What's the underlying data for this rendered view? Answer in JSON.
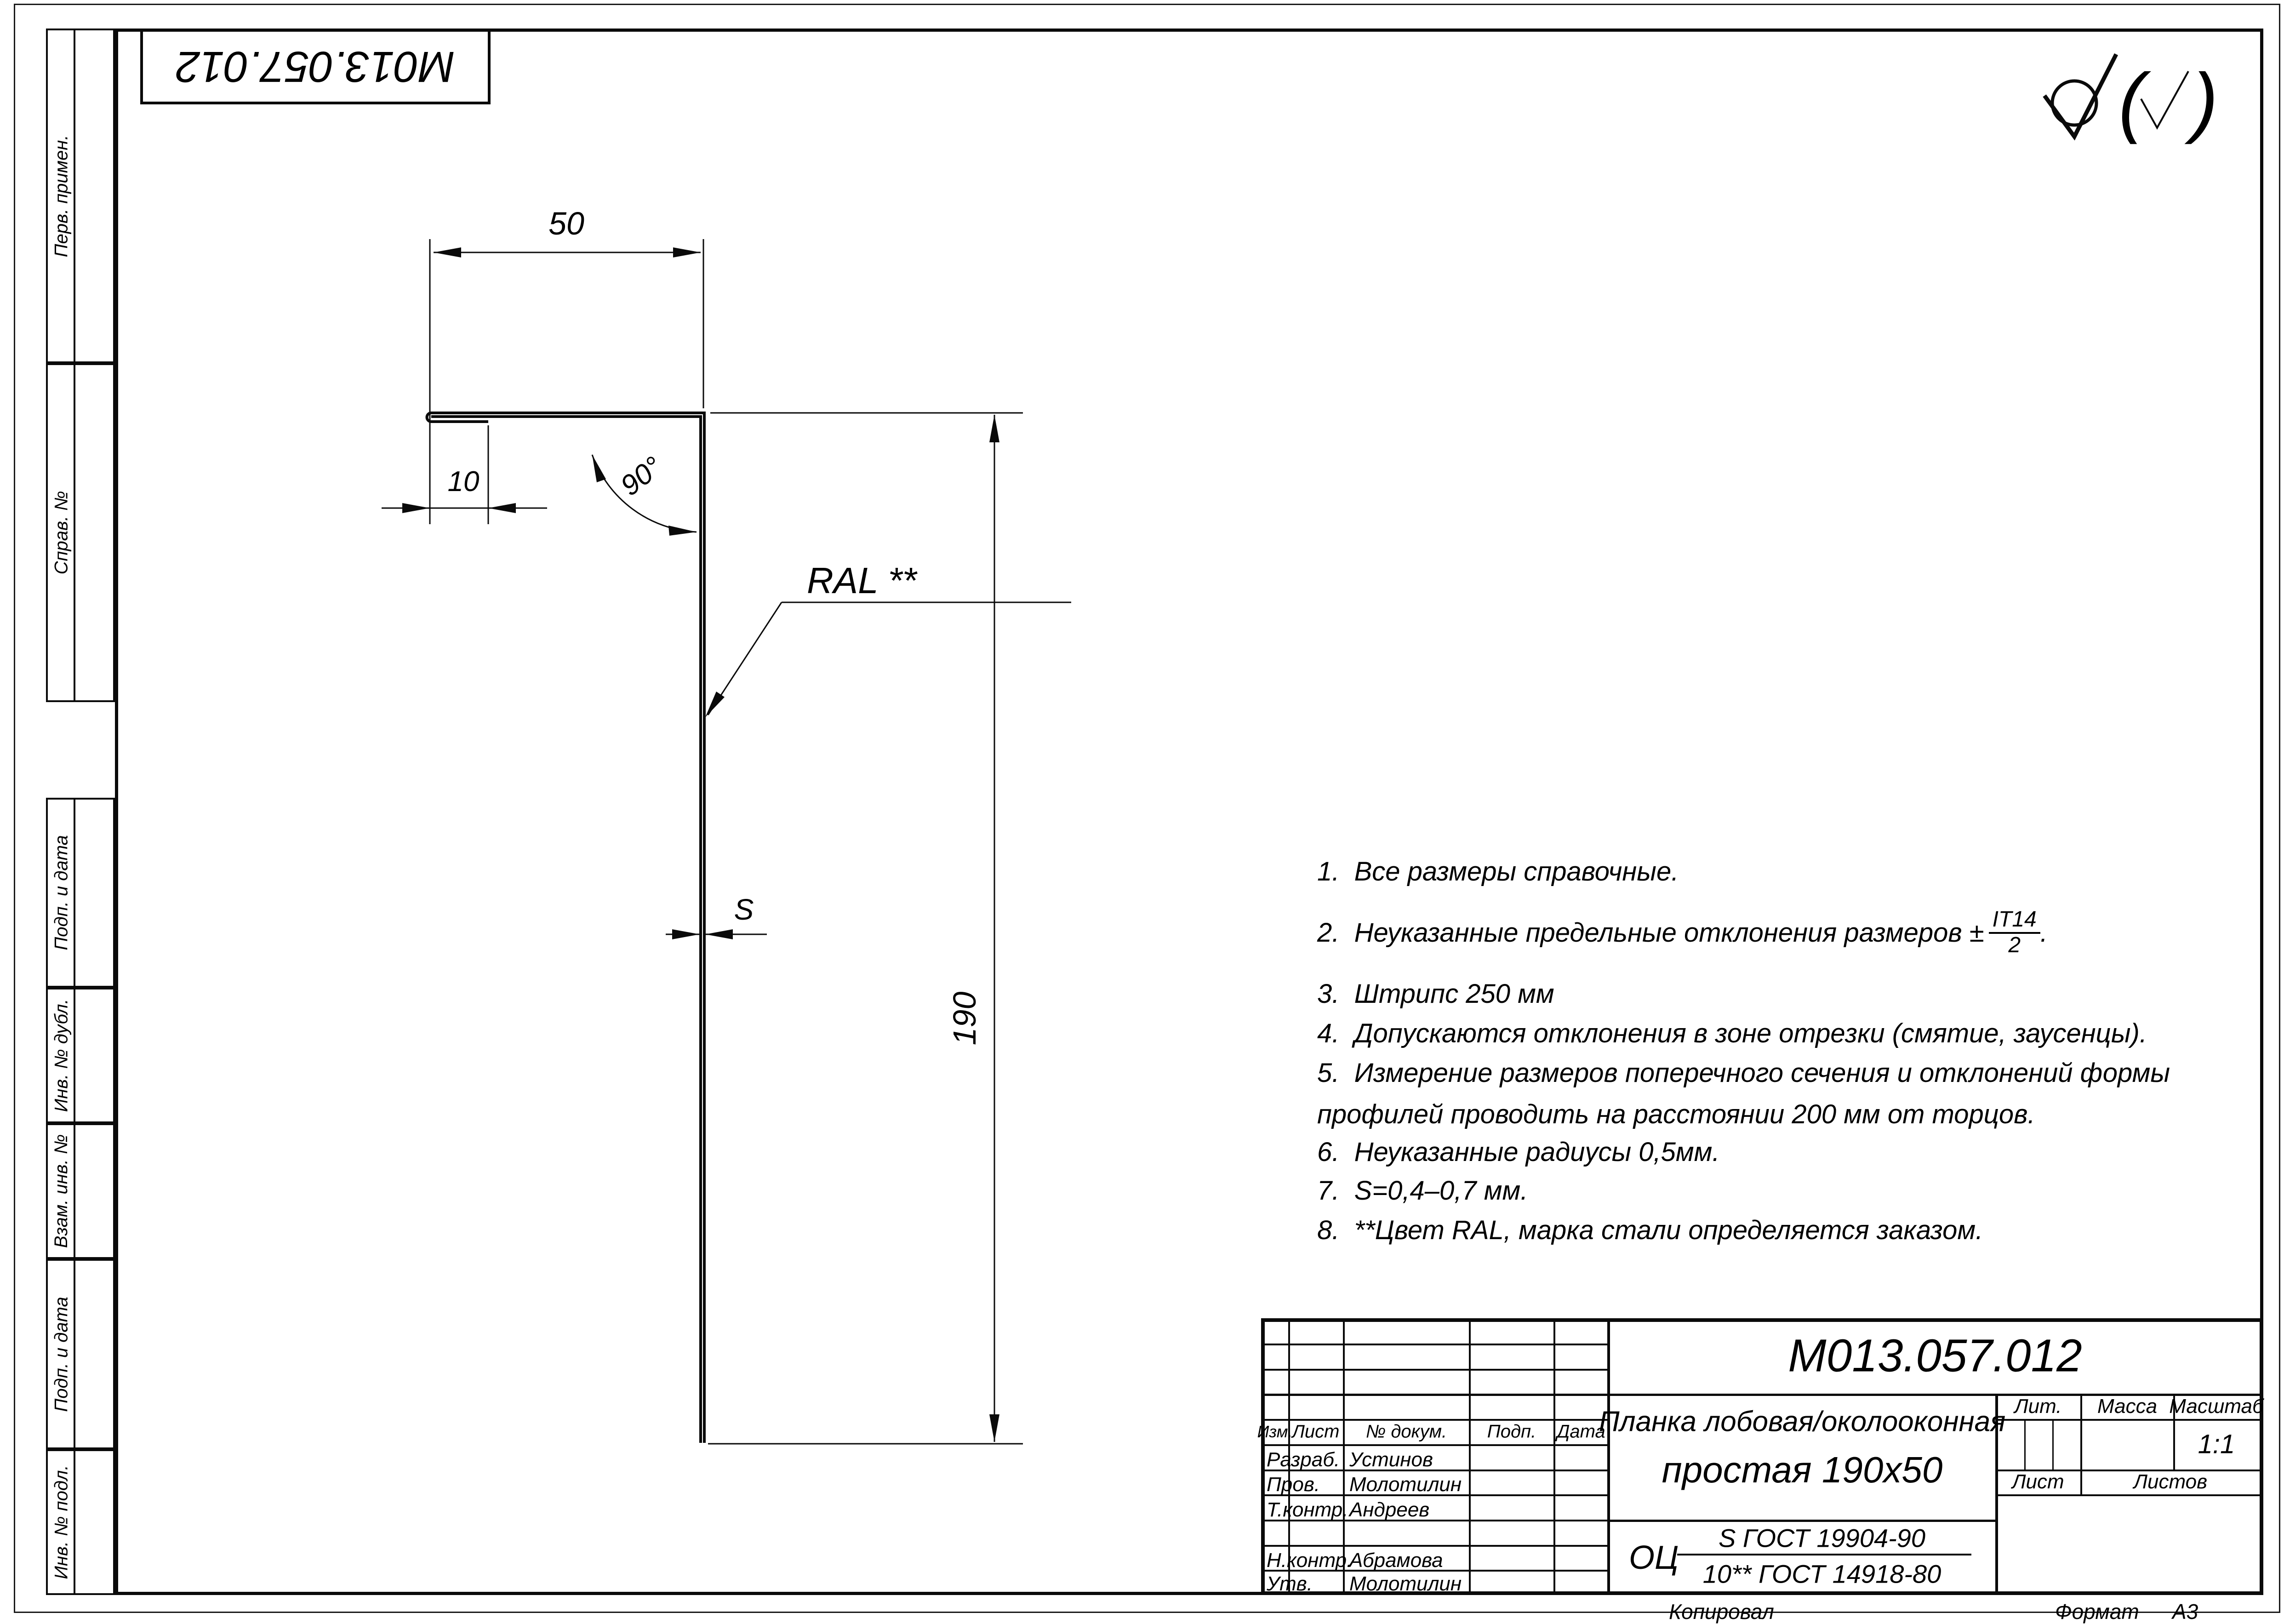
{
  "sheet": {
    "stamp_top": "М013.057.012",
    "copied_label": "Копировал",
    "format_label": "Формат",
    "format_value": "А3"
  },
  "margin_labels": {
    "perv": "Перв. примен.",
    "sprav": "Справ. №",
    "podp1": "Подп. и дата",
    "inv_dubl": "Инв. № дубл.",
    "vzam": "Взам. инв. №",
    "podp2": "Подп. и дата",
    "inv_podl": "Инв. № подл."
  },
  "drawing": {
    "dim_50": "50",
    "dim_10": "10",
    "dim_angle": "90°",
    "dim_190": "190",
    "dim_s": "S",
    "ral_label": "RAL **"
  },
  "roughness": {
    "paren_open": "(",
    "paren_close": ")"
  },
  "notes": {
    "n1": "1.  Все размеры справочные.",
    "n2_text": "2.  Неуказанные предельные отклонения размеров ±",
    "n2_frac_num": "IT14",
    "n2_frac_den": "2",
    "n2_period": ".",
    "n3": "3.  Штрипс 250 мм",
    "n4": "4.  Допускаются отклонения в зоне отрезки (смятие, заусенцы).",
    "n5a": "5.  Измерение размеров поперечного сечения и отклонений формы",
    "n5b": "профилей проводить на расстоянии 200 мм от торцов.",
    "n6": "6.  Неуказанные радиусы 0,5мм.",
    "n7": "7.  S=0,4–0,7 мм.",
    "n8": "8.  **Цвет RAL, марка стали определяется заказом."
  },
  "title_block": {
    "designation": "М013.057.012",
    "name_line1": "Планка лобовая/околооконная",
    "name_line2": "простая 190х50",
    "material_prefix": "ОЦ",
    "material_num": "S ГОСТ 19904-90",
    "material_den": "10** ГОСТ 14918-80",
    "header": {
      "izm": "Изм.",
      "list": "Лист",
      "doc": "№ докум.",
      "podp": "Подп.",
      "data": "Дата"
    },
    "rows": [
      {
        "label": "Разраб.",
        "name": "Устинов"
      },
      {
        "label": "Пров.",
        "name": "Молотилин"
      },
      {
        "label": "Т.контр.",
        "name": "Андреев"
      },
      {
        "label": "",
        "name": ""
      },
      {
        "label": "Н.контр.",
        "name": "Абрамова"
      },
      {
        "label": "Утв.",
        "name": "Молотилин"
      }
    ],
    "lit_label": "Лит.",
    "mass_label": "Масса",
    "scale_label": "Масштаб",
    "scale_value": "1:1",
    "list_label": "Лист",
    "listov_label": "Листов"
  }
}
